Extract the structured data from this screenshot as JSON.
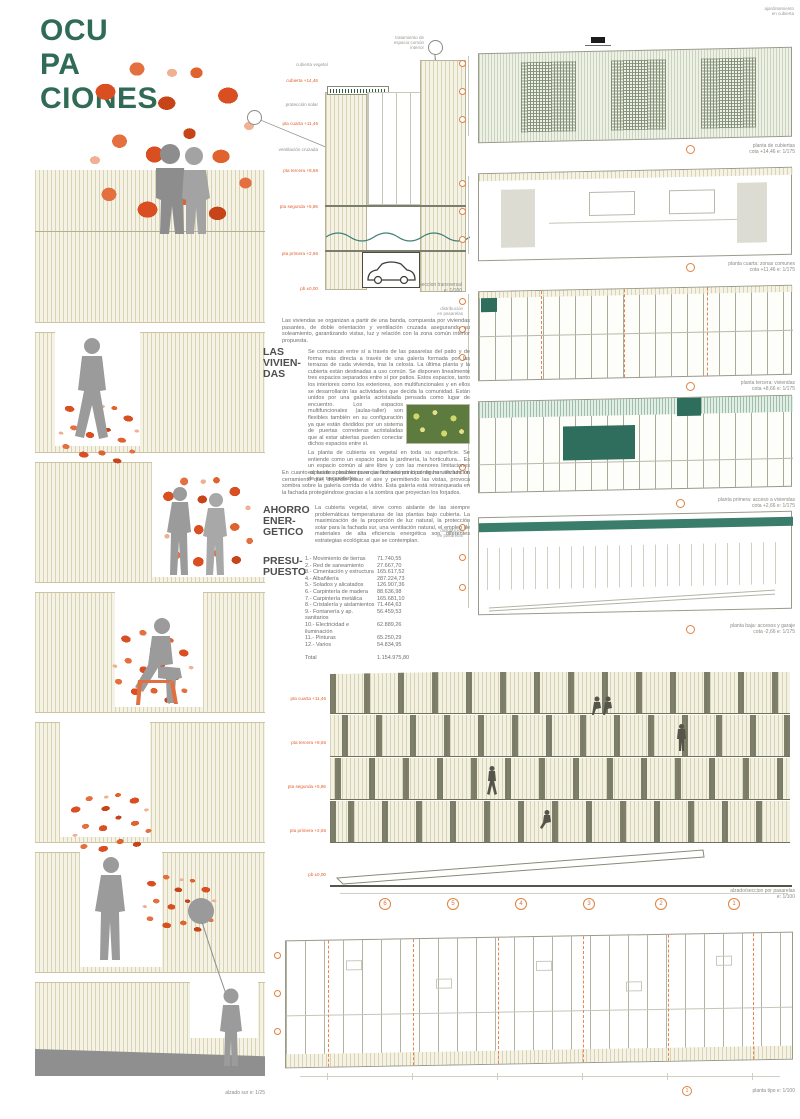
{
  "title_lines": [
    "OCU",
    "PA",
    "CIONES"
  ],
  "left_elevation": {
    "caption": "alzado sur   e: 1/25"
  },
  "section": {
    "caption_line1": "seccion transversal",
    "caption_line2": "e: 1/100",
    "bubble_note_lines": [
      "tratamiento de",
      "espacio común",
      "interior"
    ],
    "roof_note": "cubierta vegetal",
    "levels": [
      {
        "text": "cubierta +14,46"
      },
      {
        "text": "protección solar"
      },
      {
        "text": "pta cuarta +11,46"
      },
      {
        "text": "ventilación cruzada"
      },
      {
        "text": "pta tercera +8,66"
      },
      {
        "text": "pta segunda +5,86"
      },
      {
        "text": "pta primera +2,66"
      },
      {
        "text": "pb ±0,00"
      }
    ]
  },
  "viviendas": {
    "heading_lines": [
      "LAS",
      "VIVIEN-",
      "DAS"
    ],
    "intro": "Las viviendas se organizan a partir de una banda, compuesta por viviendas pasantes, de doble orientación y ventilación cruzada asegurando su soleamiento, garantizando vistas, luz y relación con la zona común interior propuesta.",
    "body1a": "Se comunican entre sí a través de las pasarelas del patio y de forma más directa a través de una galería formada por las terrazas de cada vivienda, tras la celosía. La última planta y la cubierta están destinadas a uso común. Se disponen linealmente tres espacios separados entre sí por patios. Estos espacios, tanto los interiores como los exteriores, son multifuncionales y en ellos se desarrollarán las actividades que decida la comunidad. Están unidos por una galería acristalada pensada",
    "body1b": "como lugar de encuentro. Los espacios multifuncionales (aulas-taller) son flexibles también en su configuración ya que están divididos por un sistema de puertas correderas acristaladas que al estar abiertas pueden conectar dichos espacios entre sí.",
    "body2": "La planta de cubierta es vegetal en toda su superficie. Se entiende como un espacio para la jardinería, la horticultura... Es un espacio común al aire libre y con las menores limitaciones espaciales posibles para que los vecinos lo configuren en función de sus necesidades."
  },
  "ahorro": {
    "heading_lines": [
      "AHORRO",
      "ENER-",
      "GETICO"
    ],
    "intro": "En cuanto al fuerte soleamiento en la fachada principal se ha utilizado un cerramiento que, dejando pasar el aire y permitiendo las vistas, provoca sombra sobre la galería corrida de vidrio. Esta galería está retranqueada en la fachada protegiéndose gracias a la sombra que proyectan los forjados.",
    "body": "La cubierta vegetal, sirve como aislante de las siempre problemáticas temperaturas de las plantas bajo cubierta. La maximización de la proporción de luz natural, la protección solar para la fachada sur, una ventilación natural, el empleo de materiales de alta eficiencia energética son diferentes estrategias ecológicas que se contemplan."
  },
  "budget": {
    "heading_lines": [
      "PRESU-",
      "PUESTO"
    ],
    "items": [
      {
        "label": "1.- Movimiento de tierras",
        "amount": "71.740,55"
      },
      {
        "label": "2.- Red de saneamiento",
        "amount": "27.667,70"
      },
      {
        "label": "3.- Cimentación y estructura",
        "amount": "165.617,52"
      },
      {
        "label": "4.- Albañilería",
        "amount": "287.224,73"
      },
      {
        "label": "5.- Solados y alicatados",
        "amount": "126.907,36"
      },
      {
        "label": "6.- Carpintería de madera",
        "amount": "88.636,98"
      },
      {
        "label": "7.- Carpintería metálica",
        "amount": "165.681,10"
      },
      {
        "label": "8.- Cristalería y aislamientos",
        "amount": "71.464,63"
      },
      {
        "label": "9.- Fontanería y ap. sanitarios",
        "amount": "56.459,53"
      },
      {
        "label": "10.- Electricidad e iluminación",
        "amount": "62.889,26"
      },
      {
        "label": "11.- Pinturas",
        "amount": "65.250,29"
      },
      {
        "label": "12.- Varios",
        "amount": "54.834,95"
      }
    ],
    "total_label": "Total",
    "total_amount": "1.154.975,80"
  },
  "plans": [
    {
      "line1": "planta de cubiertas",
      "line2": "cota +14,46   e: 1/175"
    },
    {
      "line1": "planta cuarta: zonas comunes",
      "line2": "cota +11,46   e: 1/175"
    },
    {
      "line1": "planta tercera: viviendas",
      "line2": "cota +8,66   e: 1/175"
    },
    {
      "line1": "planta primera: acceso a viviendas",
      "line2": "cota +2,66   e: 1/175"
    },
    {
      "line1": "planta baja: accesos y garaje",
      "line2": "cota -2,66   e: 1/175"
    }
  ],
  "bottom_elevation": {
    "label_line1": "alzado/seccion por pasarelas",
    "label_line2": "e: 1/100",
    "grid_numbers": [
      "6",
      "5",
      "4",
      "3",
      "2",
      "1"
    ],
    "levels": [
      "pta cuarta +11,46",
      "pta tercera +8,66",
      "pta segunda +5,86",
      "pta primera +2,66",
      "pb ±0,00"
    ]
  },
  "bottom_plan": {
    "label": "planta tipo   e: 1/100",
    "bubble": "1"
  },
  "micro": {
    "top_right_lines": [
      "ajardinamiento",
      "en cubierta"
    ],
    "side_lines": [
      "distribución",
      "en pasarelas"
    ]
  }
}
